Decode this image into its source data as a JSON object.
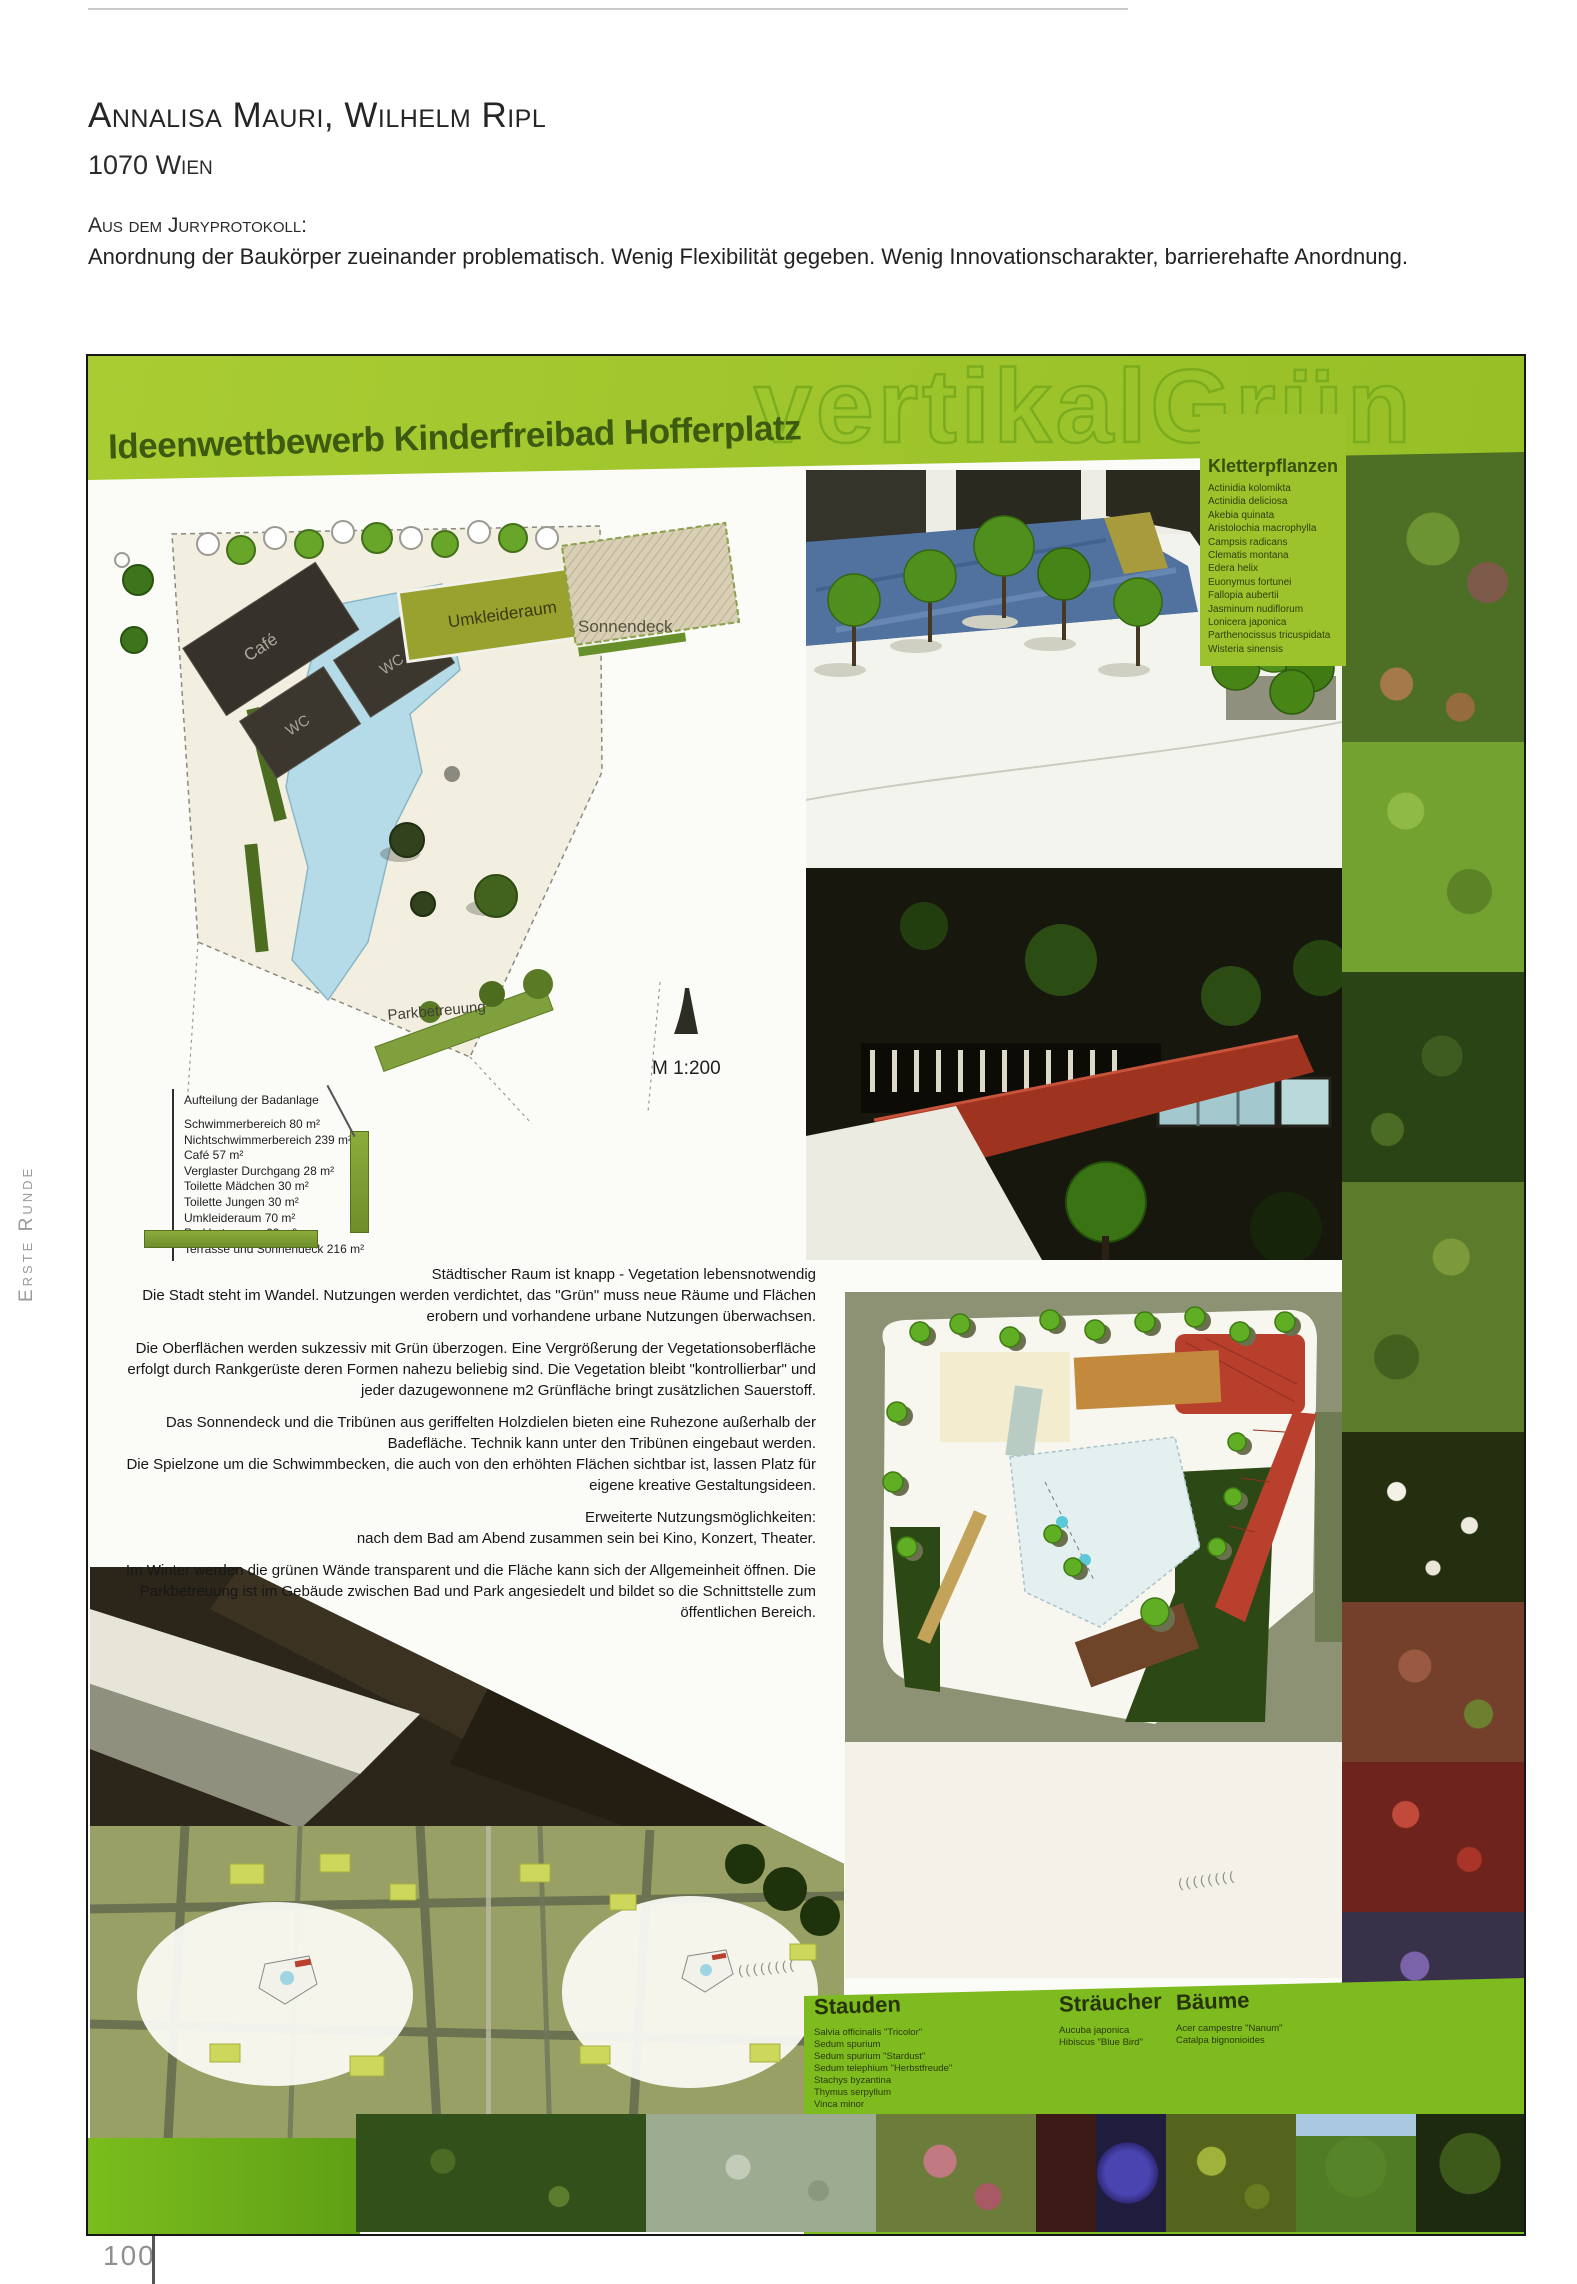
{
  "page": {
    "number": "100",
    "side_label": "Erste Runde"
  },
  "header": {
    "authors": "Annalisa Mauri, Wilhelm Ripl",
    "location": "1070 Wien",
    "jury_label": "Aus dem Juryprotokoll:",
    "jury_text": "Anordnung der Baukörper zueinander problematisch. Wenig Flexibilität gegeben. Wenig Innovationscharakter, barrierehafte Anordnung."
  },
  "poster": {
    "watermark": "vertikalGrün",
    "title": "Ideenwettbewerb Kinderfreibad Hofferplatz",
    "scale_label": "M 1:200",
    "plan_labels": {
      "cafe": "Café",
      "wc": "WC",
      "umkleideraum": "Umkleideraum",
      "sonnendeck": "Sonnendeck",
      "parkbetreuung": "Parkbetreuung"
    },
    "area_table": {
      "title": "Aufteilung der Badanlage",
      "rows": [
        "Schwimmerbereich 80 m²",
        "Nichtschwimmerbereich 239 m²",
        "Café 57 m²",
        "Verglaster Durchgang 28 m²",
        "Toilette Mädchen 30 m²",
        "Toilette Jungen 30 m²",
        "Umkleideraum 70 m²",
        "Parkbetreuung 60 m²",
        "Terrasse und Sonnendeck 216 m²"
      ]
    },
    "paragraphs": [
      "Städtischer Raum ist knapp - Vegetation lebensnotwendig\nDie Stadt steht im Wandel. Nutzungen werden verdichtet, das \"Grün\" muss neue Räume und Flächen erobern und vorhandene urbane Nutzungen überwachsen.",
      "Die Oberflächen werden sukzessiv mit Grün überzogen. Eine Vergrößerung der Vegetationsoberfläche erfolgt durch Rankgerüste deren Formen nahezu beliebig sind. Die Vegetation bleibt \"kontrollierbar\" und jeder dazugewonnene m2 Grünfläche bringt zusätzlichen Sauerstoff.",
      "Das Sonnendeck und die Tribünen aus geriffelten Holzdielen bieten eine Ruhezone außerhalb der Badefläche. Technik kann unter den Tribünen eingebaut werden.\nDie Spielzone um die Schwimmbecken, die auch von den erhöhten Flächen sichtbar ist, lassen Platz für eigene kreative Gestaltungsideen.",
      "Erweiterte Nutzungsmöglichkeiten:\nnach dem Bad am Abend zusammen sein bei Kino, Konzert, Theater.",
      "Im Winter werden die grünen Wände transparent und die Fläche kann sich der Allgemeinheit öffnen. Die Parkbetreuung ist im Gebäude zwischen Bad und Park angesiedelt und bildet so die Schnittstelle zum öffentlichen Bereich."
    ],
    "plant_lists": {
      "kletterpflanzen": {
        "title": "Kletterpflanzen",
        "items": [
          "Actinidia kolomikta",
          "Actinidia deliciosa",
          "Akebia quinata",
          "Aristolochia macrophylla",
          "Campsis radicans",
          "Clematis montana",
          "Edera helix",
          "Euonymus fortunei",
          "Fallopia aubertii",
          "Jasminum nudiflorum",
          "Lonicera japonica",
          "Parthenocissus tricuspidata",
          "Wisteria sinensis"
        ]
      },
      "stauden": {
        "title": "Stauden",
        "items": [
          "Salvia officinalis \"Tricolor\"",
          "Sedum spurium",
          "Sedum spurium \"Stardust\"",
          "Sedum telephium \"Herbstfreude\"",
          "Stachys byzantina",
          "Thymus serpyllum",
          "Vinca minor"
        ]
      },
      "straeucher": {
        "title": "Sträucher",
        "items": [
          "Aucuba japonica",
          "Hibiscus \"Blue Bird\""
        ]
      },
      "baeume": {
        "title": "Bäume",
        "items": [
          "Acer campestre \"Nanum\"",
          "Catalpa bignonioides"
        ]
      }
    },
    "decorative_ticks": "((((((((",
    "colors": {
      "band_green": "#a6c92f",
      "bottom_band_green": "#7dbb1f",
      "title_green": "#3c5a10"
    }
  }
}
